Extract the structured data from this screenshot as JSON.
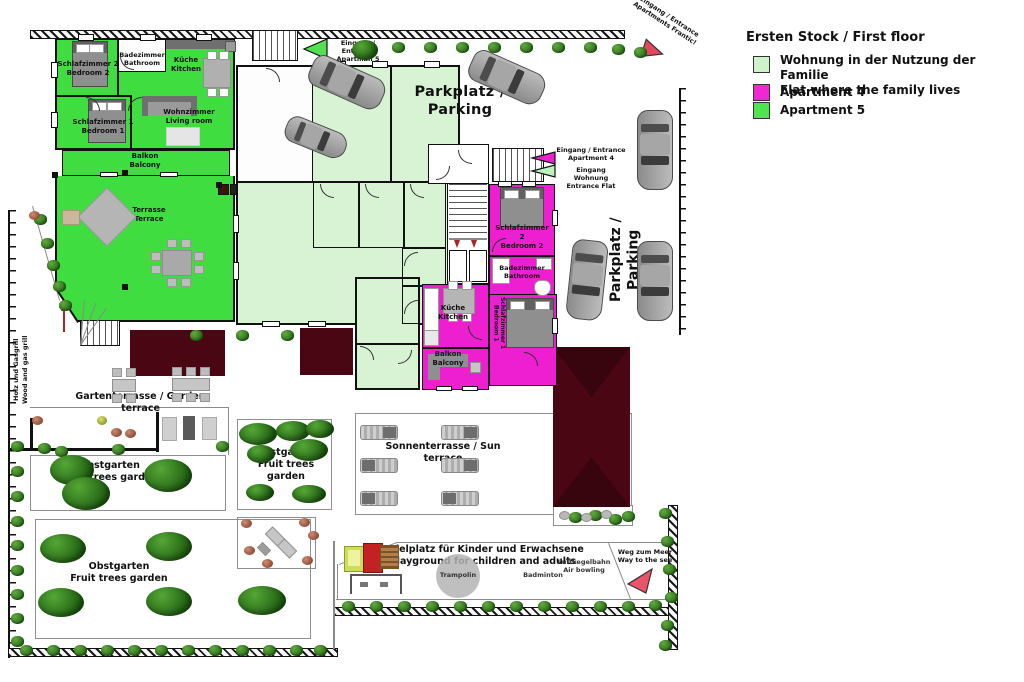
{
  "legend": {
    "title": "Ersten Stock / First floor",
    "items": [
      {
        "label": "Wohnung in der Nutzung der Familie\nFlat where the family lives",
        "color": "#cdf4c9"
      },
      {
        "label": "Apartment 4",
        "color": "#f227d4"
      },
      {
        "label": "Apartment 5",
        "color": "#4ee44e"
      }
    ]
  },
  "colors": {
    "apt5": "#3fdd3f",
    "apt4": "#ee1fd1",
    "flat": "#d7f3d4",
    "roof": "#4a0612"
  },
  "parking": {
    "top_label": "Parkplatz / Parking",
    "right_label": "Parkplatz / Parking"
  },
  "entrances": {
    "apartman5": "Eingang / Entrance\nApartman 5",
    "apartments_frantic": "Eingang / Entrance\nApartments Frantic!",
    "apartment4": "Eingang / Entrance\nApartment 4",
    "flat": "Eingang Wohnung\nEntrance Flat"
  },
  "apartment5": {
    "bedroom2": "Schlafzimmer 2\nBedroom 2",
    "bathroom": "Badezimmer\nBathroom",
    "kitchen": "Küche\nKitchen",
    "living_room": "Wohnzimmer\nLiving room",
    "bedroom1": "Schlafzimmer 1\nBedroom 1",
    "balcony": "Balkon\nBalcony",
    "terrace": "Terrasse\nTerrace"
  },
  "apartment4": {
    "bedroom2": "Schlafzimmer 2\nBedroom 2",
    "bathroom": "Badezimmer\nBathroom",
    "kitchen": "Küche\nKitchen",
    "bedroom1": "Schlafzimmer 1\nBedroom 1",
    "balcony": "Balkon\nBalcony"
  },
  "garden": {
    "wood_gas_grill": "Holz und Gasgrill\nWood and gas grill",
    "gas_grill": "Gasgrill\nGas grill",
    "garden_terrace": "Gartenterrasse / Garden terrace",
    "fruit_garden": "Obstgarten\nFruit trees garden",
    "sun_terrace": "Sonnenterrasse / Sun terrace",
    "playground": "Spielplatz für Kinder und Erwachsene\nPlayground for children and adults",
    "trampoline": "Trampolin",
    "badminton": "Badminton",
    "air_bowling": "Luftkegelbahn\nAir bowling",
    "way_to_sea": "Weg zum Meer\nWay to the see"
  }
}
